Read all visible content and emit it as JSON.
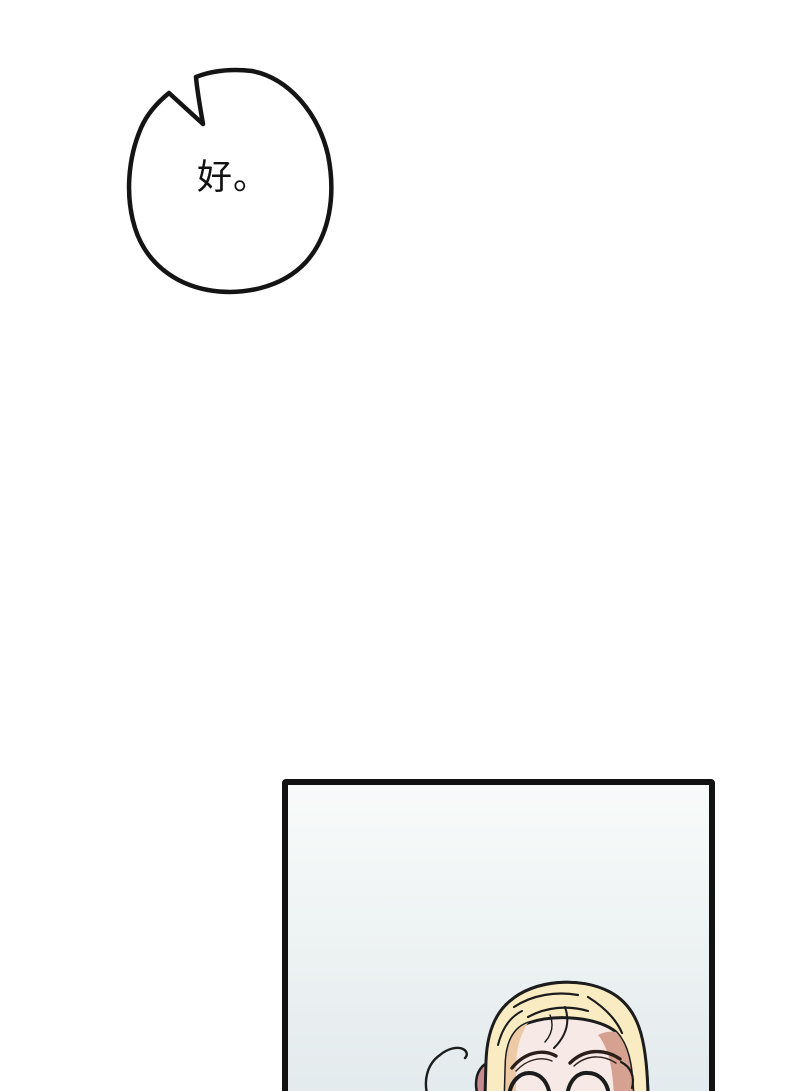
{
  "speech_bubble": {
    "text": "好。",
    "fill_color": "#ffffff",
    "outline_color": "#141414",
    "text_color": "#111111"
  },
  "panel": {
    "border_color": "#121212",
    "background_top_color": "#f8fbfa",
    "background_bottom_color": "#e3eaed"
  },
  "character": {
    "expression": "smiling-eyes-closed",
    "hair_color": "#f9ecc2",
    "hair_shadow_color": "#d5a191",
    "hair_peach_color": "#eccaa6",
    "skin_color": "#f7e9e5",
    "ear_color": "#c68b90",
    "outline_color": "#1c1c1c",
    "brow_color": "#2b2019"
  }
}
